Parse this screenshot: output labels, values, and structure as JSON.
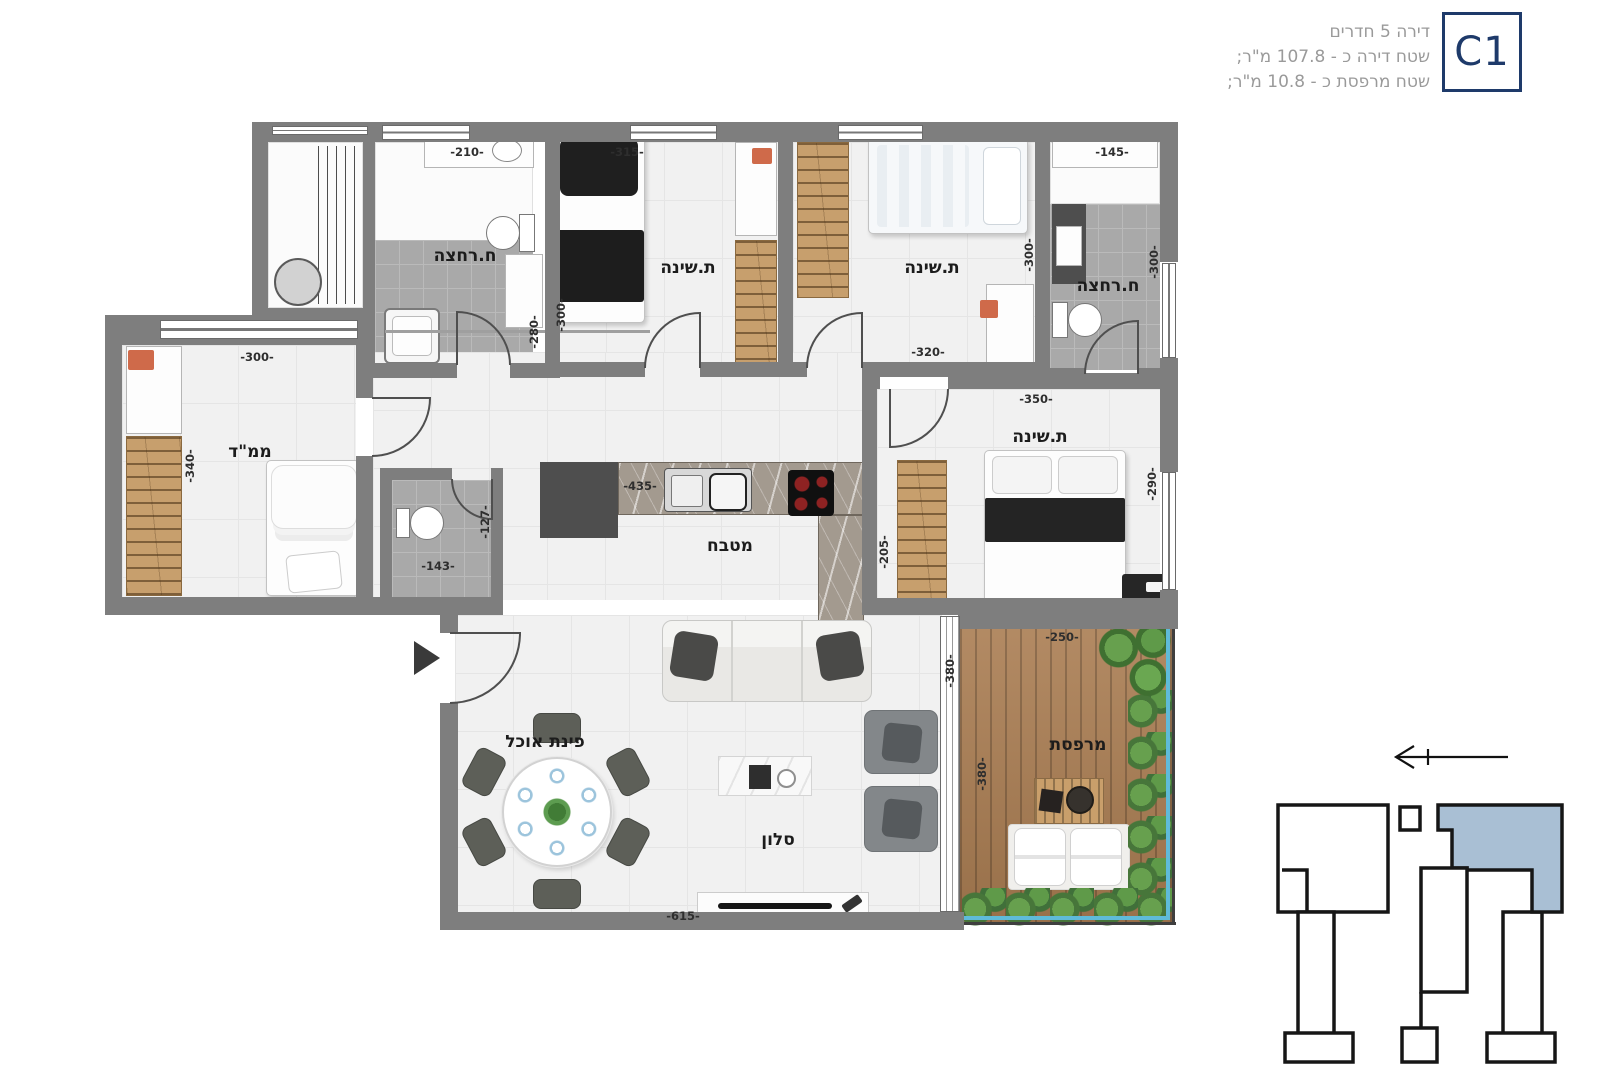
{
  "header": {
    "line1": "דירה 5 חדרים",
    "line2": "שטח דירה כ - 107.8 מ\"ר;",
    "line3": "שטח מרפסת כ - 10.8 מ\"ר;",
    "unit_code": "C1"
  },
  "compass": {
    "letter": "N"
  },
  "colors": {
    "accent_navy": "#1e3a6a",
    "keyplan_highlight": "#a9bfd4",
    "wall_gray": "#7e7e7e",
    "wood": "#c79f6d",
    "deck_wood": "#aa7d52",
    "hedge_green": "#5f9a49",
    "railing_blue": "#5fbbd9"
  },
  "room_labels": [
    {
      "text": "ח.רחצה",
      "x": 465,
      "y": 256
    },
    {
      "text": "ת.שינה",
      "x": 688,
      "y": 268
    },
    {
      "text": "ת.שינה",
      "x": 932,
      "y": 268
    },
    {
      "text": "ח.רחצה",
      "x": 1108,
      "y": 286
    },
    {
      "text": "ממ\"ד",
      "x": 250,
      "y": 452
    },
    {
      "text": "מטבח",
      "x": 730,
      "y": 546
    },
    {
      "text": "ת.שינה",
      "x": 1040,
      "y": 437
    },
    {
      "text": "פינת אוכל",
      "x": 545,
      "y": 742
    },
    {
      "text": "סלון",
      "x": 778,
      "y": 840
    },
    {
      "text": "מרפסת",
      "x": 1078,
      "y": 745
    }
  ],
  "dim_labels": [
    {
      "text": "-210-",
      "x": 467,
      "y": 152,
      "v": false
    },
    {
      "text": "-315-",
      "x": 627,
      "y": 152,
      "v": false
    },
    {
      "text": "-145-",
      "x": 1112,
      "y": 152,
      "v": false
    },
    {
      "text": "-300-",
      "x": 561,
      "y": 315,
      "v": true
    },
    {
      "text": "-280-",
      "x": 534,
      "y": 332,
      "v": true
    },
    {
      "text": "-300-",
      "x": 1029,
      "y": 255,
      "v": true
    },
    {
      "text": "-300-",
      "x": 1154,
      "y": 262,
      "v": true
    },
    {
      "text": "-320-",
      "x": 928,
      "y": 352,
      "v": false
    },
    {
      "text": "-300-",
      "x": 257,
      "y": 357,
      "v": false
    },
    {
      "text": "-340-",
      "x": 190,
      "y": 466,
      "v": true
    },
    {
      "text": "-143-",
      "x": 438,
      "y": 566,
      "v": false
    },
    {
      "text": "-127-",
      "x": 485,
      "y": 522,
      "v": true
    },
    {
      "text": "-435-",
      "x": 640,
      "y": 486,
      "v": false
    },
    {
      "text": "-205-",
      "x": 884,
      "y": 552,
      "v": true
    },
    {
      "text": "-350-",
      "x": 1036,
      "y": 399,
      "v": false
    },
    {
      "text": "-290-",
      "x": 1152,
      "y": 484,
      "v": true
    },
    {
      "text": "-250-",
      "x": 1062,
      "y": 637,
      "v": false
    },
    {
      "text": "-380-",
      "x": 950,
      "y": 671,
      "v": true
    },
    {
      "text": "-380-",
      "x": 982,
      "y": 774,
      "v": true
    },
    {
      "text": "-615-",
      "x": 683,
      "y": 916,
      "v": false
    }
  ]
}
